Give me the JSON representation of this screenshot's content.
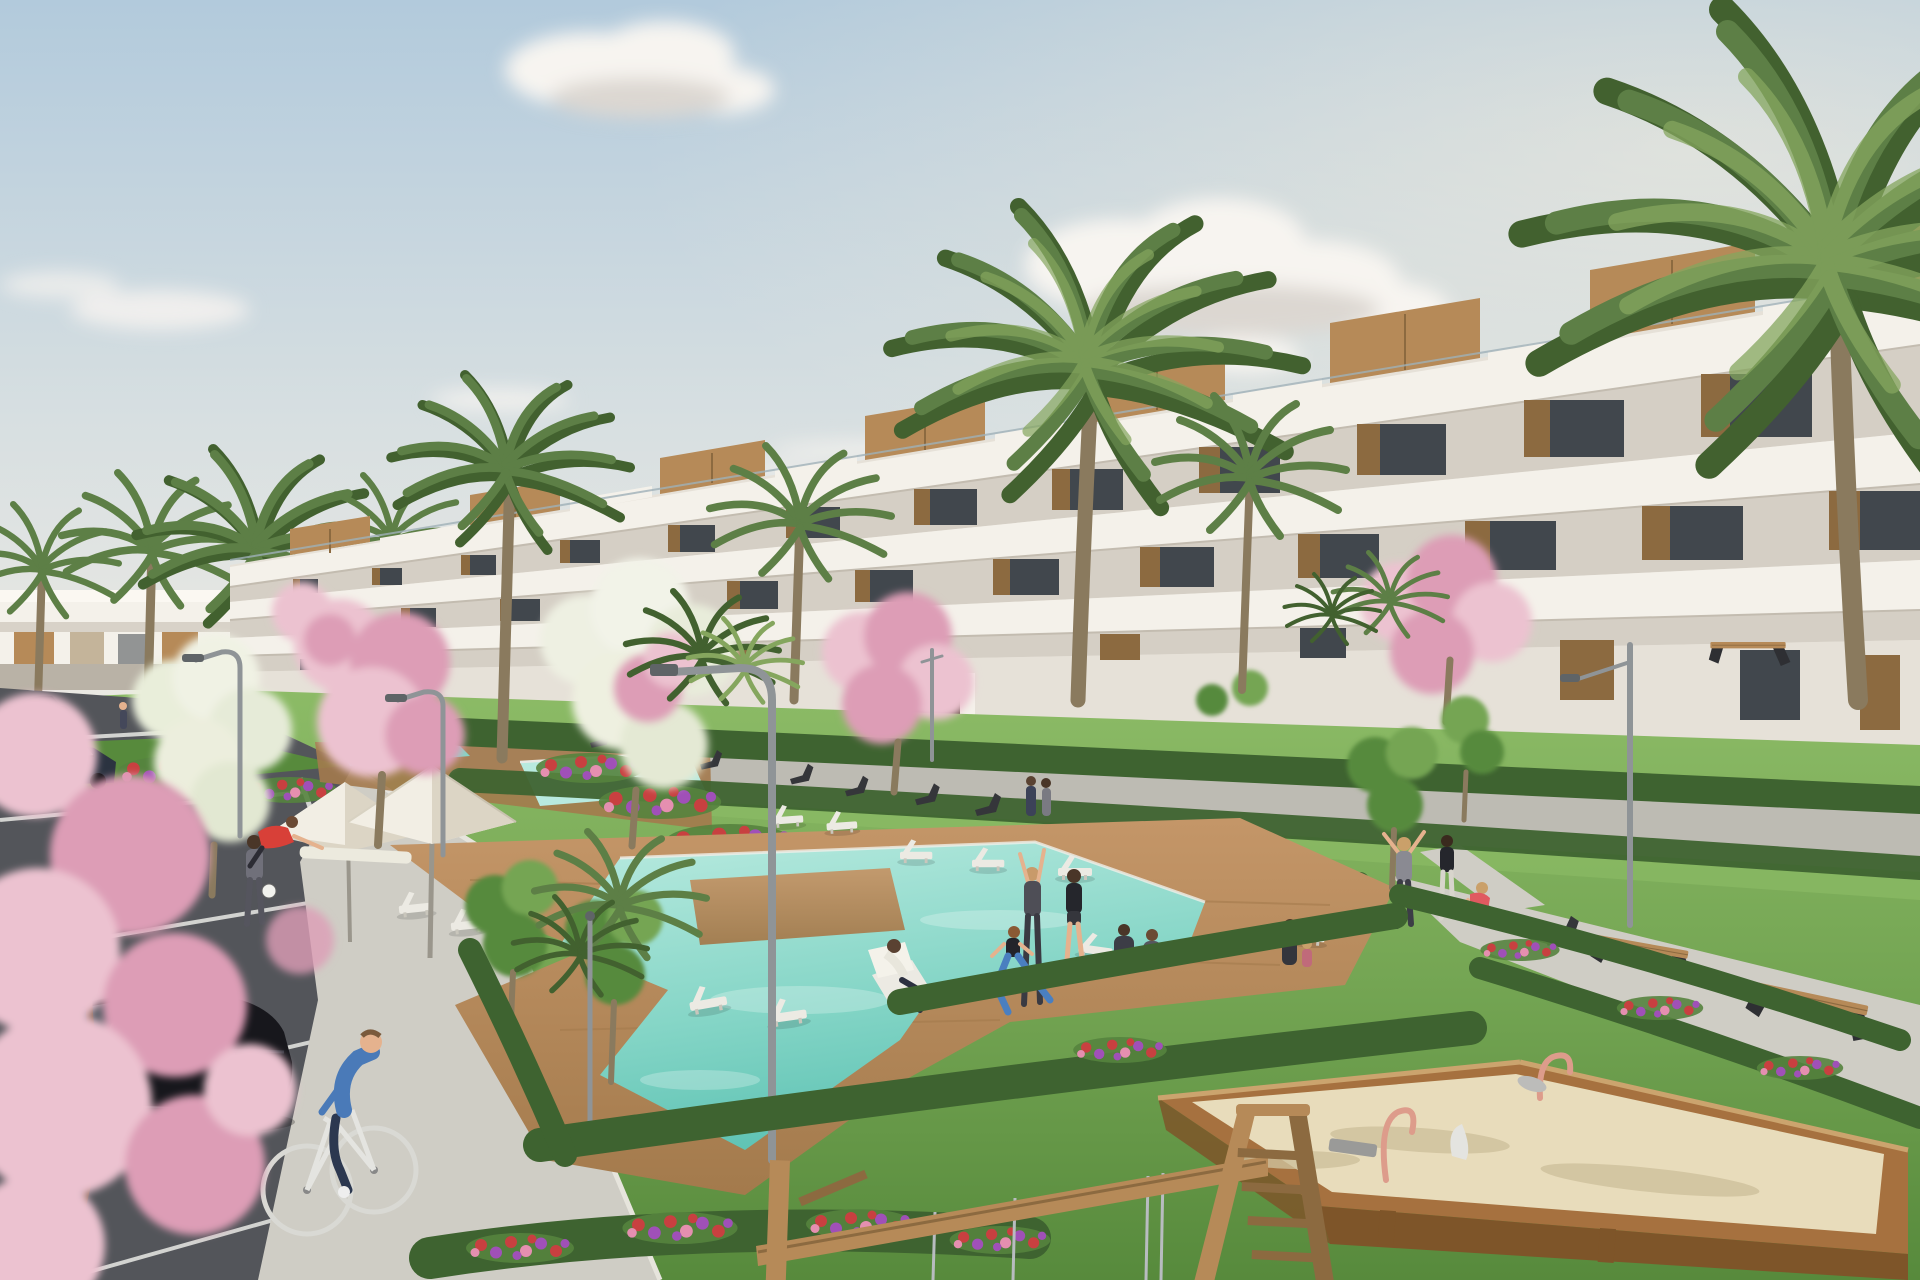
{
  "meta": {
    "kind": "architectural-render",
    "view": "residential complex with pool gardens, parking and playground"
  },
  "palette": {
    "sky-top": "#b2cadc",
    "sky-mid": "#d7dfe1",
    "sky-horizon": "#efebe3",
    "cloud": "#f7f4f0",
    "cloud-shade": "#dcd7d1",
    "bld-white": "#f4f1ea",
    "bld-white2": "#e6e1d8",
    "bld-recess": "#d5cfc5",
    "wood": "#b68a58",
    "wood-dark": "#8c6a40",
    "wood-light": "#cba46e",
    "glass": "#41474d",
    "rail": "#9fb0b8",
    "palm": "#5d7f46",
    "palm-dark": "#42612f",
    "palm-light": "#85a65e",
    "trunk": "#8a7a5e",
    "grass": "#74a553",
    "grass-light": "#8cbb66",
    "grass-dark": "#578a3c",
    "hedge": "#3e6330",
    "blossom": "#ecc2d0",
    "blossom-deep": "#dd9db6",
    "flower-red": "#c84040",
    "flower-purple": "#a050b8",
    "flower-pink": "#e58fb0",
    "pool": "#84d5c6",
    "pool-light": "#b8eadf",
    "pool-deep": "#5fc3b4",
    "deck": "#c49668",
    "deck-dark": "#a37a4c",
    "path": "#bdbbb3",
    "path-light": "#cfcdc5",
    "asphalt": "#53555a",
    "line-white": "#e9e9e5",
    "car-black": "#17171c",
    "car-glass": "#555b63",
    "rim-yellow": "#c8a23a",
    "metal": "#8f9497",
    "metal-dark": "#5f6467",
    "sand": "#e8dcbb",
    "sand-shadow": "#cfc19c",
    "sandbox-wood": "#a6713f",
    "sandbox-wood-dark": "#7e5529",
    "toy-pink": "#dd9c8b",
    "toy-grey": "#bcbcba",
    "skin": "#e5b28e",
    "teal-top": "#4fc0b0",
    "pink-top": "#e898b0",
    "red-shirt": "#d84038",
    "blue-sweater": "#4a7ab8",
    "jeans": "#2c3850",
    "grey-outfit": "#70707a",
    "black-outfit": "#25262c",
    "blue-leggings": "#4a7fc0",
    "lounger": "#eceae3",
    "umbrella": "#f2eee4",
    "umbrella-shade": "#dcd5c5"
  },
  "scene": {
    "objects": [
      "sky",
      "clouds",
      "sun-glow",
      "distant-building",
      "apartment-building",
      "roof-terraces",
      "palm-trees",
      "blossom-trees",
      "green-trees",
      "white-blossom-trees",
      "lawns",
      "hedges",
      "flower-beds",
      "walkways",
      "parking-lot",
      "parking-lines",
      "upper-pools",
      "main-pool",
      "pool-deck",
      "sun-loungers",
      "deck-chairs",
      "parasols",
      "street-lamps",
      "arc-lamp",
      "benches",
      "black-hatchback",
      "dark-sedan",
      "distant-car",
      "cyclist",
      "joggers",
      "football-walker",
      "stretching-man",
      "yoga-group",
      "deckchair-man",
      "path-people",
      "sitting-woman",
      "sandbox",
      "spring-riders",
      "swing-frame",
      "foreground-blossoms"
    ]
  }
}
